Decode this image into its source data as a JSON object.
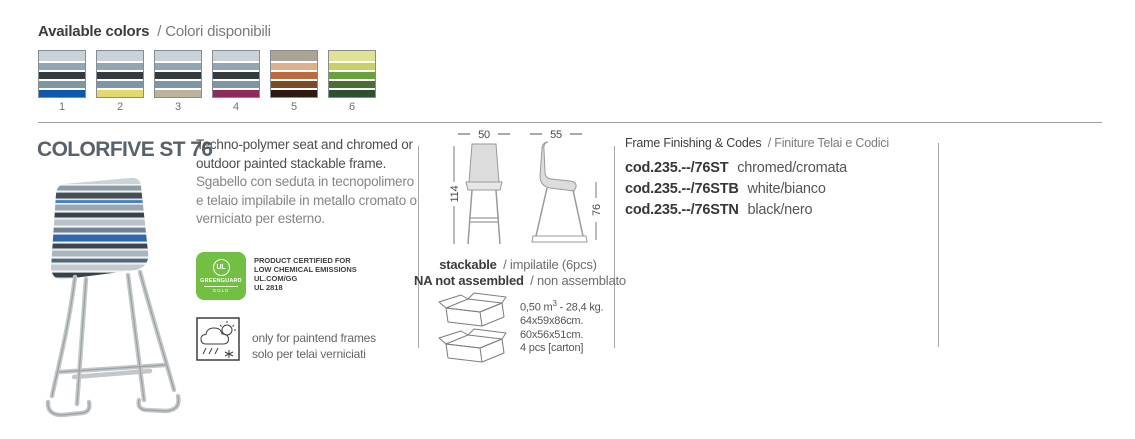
{
  "page": {
    "available_colors": {
      "title_en": "Available colors",
      "title_it": "/ Colori disponibili",
      "swatches": [
        {
          "number": "1",
          "stripes": [
            "#c9d2d8",
            "#93a5b0",
            "#333b40",
            "#7e95a3",
            "#0d57af"
          ]
        },
        {
          "number": "2",
          "stripes": [
            "#c9d2d8",
            "#93a5b0",
            "#333b40",
            "#7e95a3",
            "#e3d86e"
          ]
        },
        {
          "number": "3",
          "stripes": [
            "#c9d2d8",
            "#93a5b0",
            "#333b40",
            "#7e95a3",
            "#bdb29c"
          ]
        },
        {
          "number": "4",
          "stripes": [
            "#c9d2d8",
            "#93a5b0",
            "#333b40",
            "#7e95a3",
            "#8e2a5b"
          ]
        },
        {
          "number": "5",
          "stripes": [
            "#aba394",
            "#dcb28c",
            "#bc6b3e",
            "#7c4a28",
            "#2e1a10"
          ]
        },
        {
          "number": "6",
          "stripes": [
            "#e0e295",
            "#c6d268",
            "#68a03e",
            "#4f6c38",
            "#2d512f"
          ]
        }
      ]
    },
    "product": {
      "title": "COLORFIVE ST 76",
      "description_en": "Techno-polymer seat and chromed or outdoor painted stackable frame.",
      "description_it": "Sgabello con seduta in tecnopolimero e telaio impilabile in metallo cromato o verniciato per esterno."
    },
    "certifications": {
      "greenguard": {
        "color": "#72bf44",
        "circle_label": "UL",
        "name": "GREENGUARD",
        "tier": "GOLD",
        "lines": [
          "PRODUCT CERTIFIED FOR",
          "LOW CHEMICAL EMISSIONS",
          "UL.COM/GG",
          "UL 2818"
        ]
      },
      "outdoor_note_en": "only for paintend frames",
      "outdoor_note_it": "solo per telai verniciati"
    },
    "dimensions": {
      "width_front": "50",
      "width_side": "55",
      "height_total": "114",
      "height_seat": "76",
      "stackable_en": "stackable",
      "stackable_it": "/ impilatile (6pcs)",
      "assembled_en": "NA not assembled",
      "assembled_it": "/ non assemblato"
    },
    "packaging": {
      "volume_prefix": "0,50 m",
      "volume_exp": "3",
      "volume_suffix": " - 28,4 kg.",
      "size_outer": "64x59x86cm.",
      "size_inner": "60x56x51cm.",
      "qty": "4 pcs [carton]"
    },
    "codes": {
      "header_en": "Frame Finishing & Codes",
      "header_it": "/ Finiture Telai e Codici",
      "items": [
        {
          "code": "cod.235.--/76ST",
          "finish": "chromed/cromata"
        },
        {
          "code": "cod.235.--/76STB",
          "finish": "white/bianco"
        },
        {
          "code": "cod.235.--/76STN",
          "finish": "black/nero"
        }
      ]
    }
  }
}
